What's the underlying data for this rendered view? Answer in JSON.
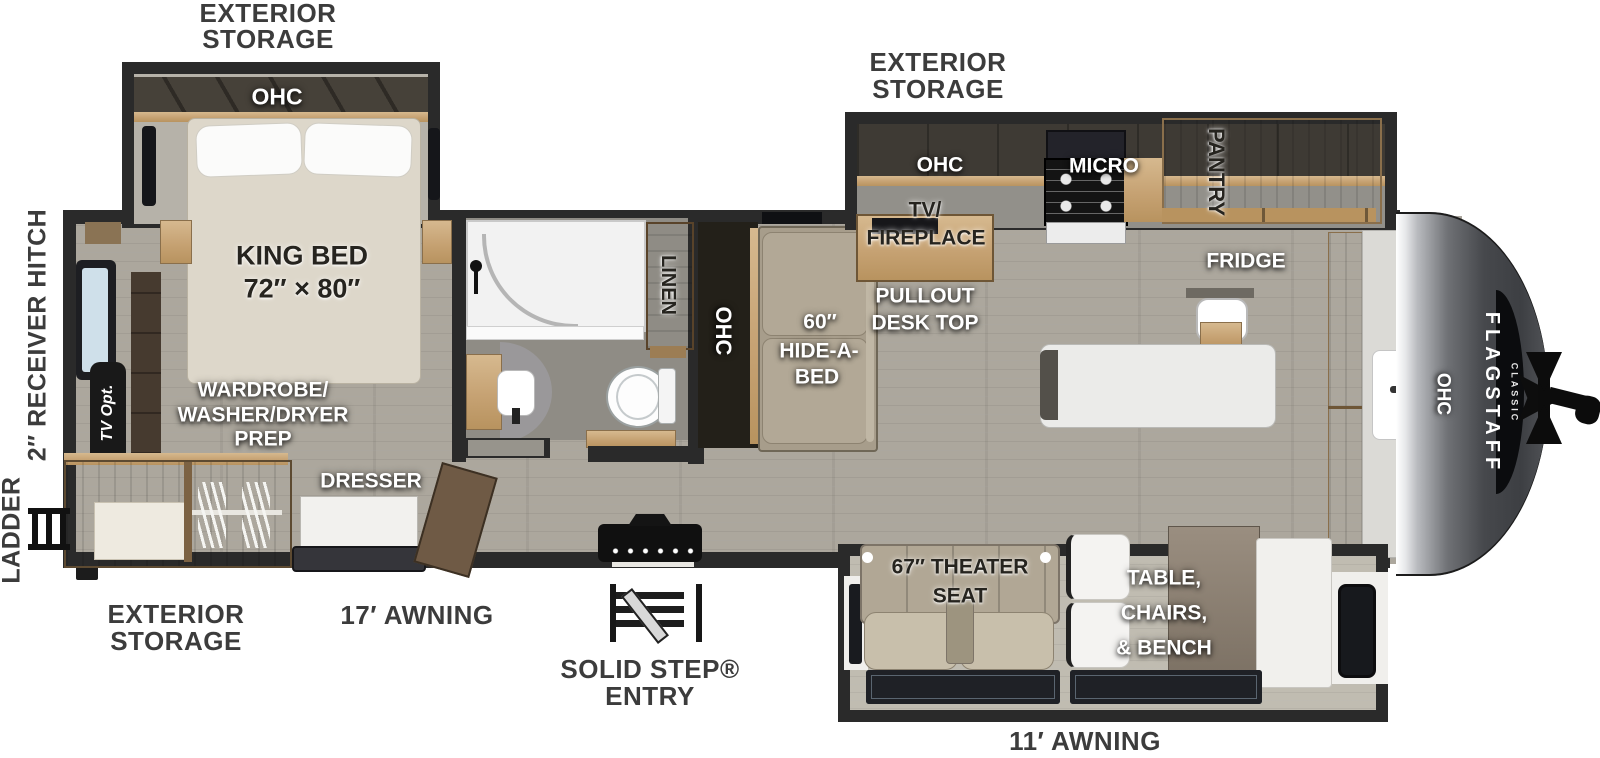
{
  "title": "Flagstaff Classic Travel Trailer Floor Plan",
  "colors": {
    "wall": "#2a2a2a",
    "floor": "#aca79d",
    "wood": "#c6a273",
    "cap_dark": "#3d3f43",
    "label_exterior": "#3c3c3c",
    "label_interior_light": "#ffffff",
    "label_interior_dark": "#26241f"
  },
  "labels": {
    "ext_storage_rear": {
      "line1": "EXTERIOR",
      "line2": "STORAGE"
    },
    "ext_storage_kitchen": {
      "line1": "EXTERIOR",
      "line2": "STORAGE"
    },
    "ext_storage_bottom": {
      "line1": "EXTERIOR",
      "line2": "STORAGE"
    },
    "awning_17": "17′ AWNING",
    "awning_11": "11′ AWNING",
    "solid_step": {
      "line1": "SOLID STEP®",
      "line2": "ENTRY"
    },
    "receiver_hitch": "2″ RECEIVER HITCH",
    "ladder": "LADDER",
    "tv_opt": "TV Opt.",
    "bedroom": {
      "ohc": "OHC",
      "bed_line1": "KING BED",
      "bed_line2": "72″ × 80″",
      "wardrobe_line1": "WARDROBE/",
      "wardrobe_line2": "WASHER/DRYER",
      "wardrobe_line3": "PREP",
      "dresser": "DRESSER"
    },
    "bathroom": {
      "linen": "LINEN"
    },
    "living": {
      "ohc": "OHC",
      "hide_a_bed_line1": "60″",
      "hide_a_bed_line2": "HIDE-A-",
      "hide_a_bed_line3": "BED",
      "theater_line1": "67″ THEATER",
      "theater_line2": "SEAT",
      "dinette_line1": "TABLE,",
      "dinette_line2": "CHAIRS,",
      "dinette_line3": "& BENCH"
    },
    "kitchen": {
      "ohc": "OHC",
      "tv_fireplace_line1": "TV/",
      "tv_fireplace_line2": "FIREPLACE",
      "pullout_line1": "PULLOUT",
      "pullout_line2": "DESK TOP",
      "micro": "MICRO",
      "pantry": "PANTRY",
      "fridge": "FRIDGE",
      "ohc_front": "OHC"
    },
    "brand": {
      "name": "FLAGSTAFF",
      "series": "CLASSIC"
    }
  }
}
